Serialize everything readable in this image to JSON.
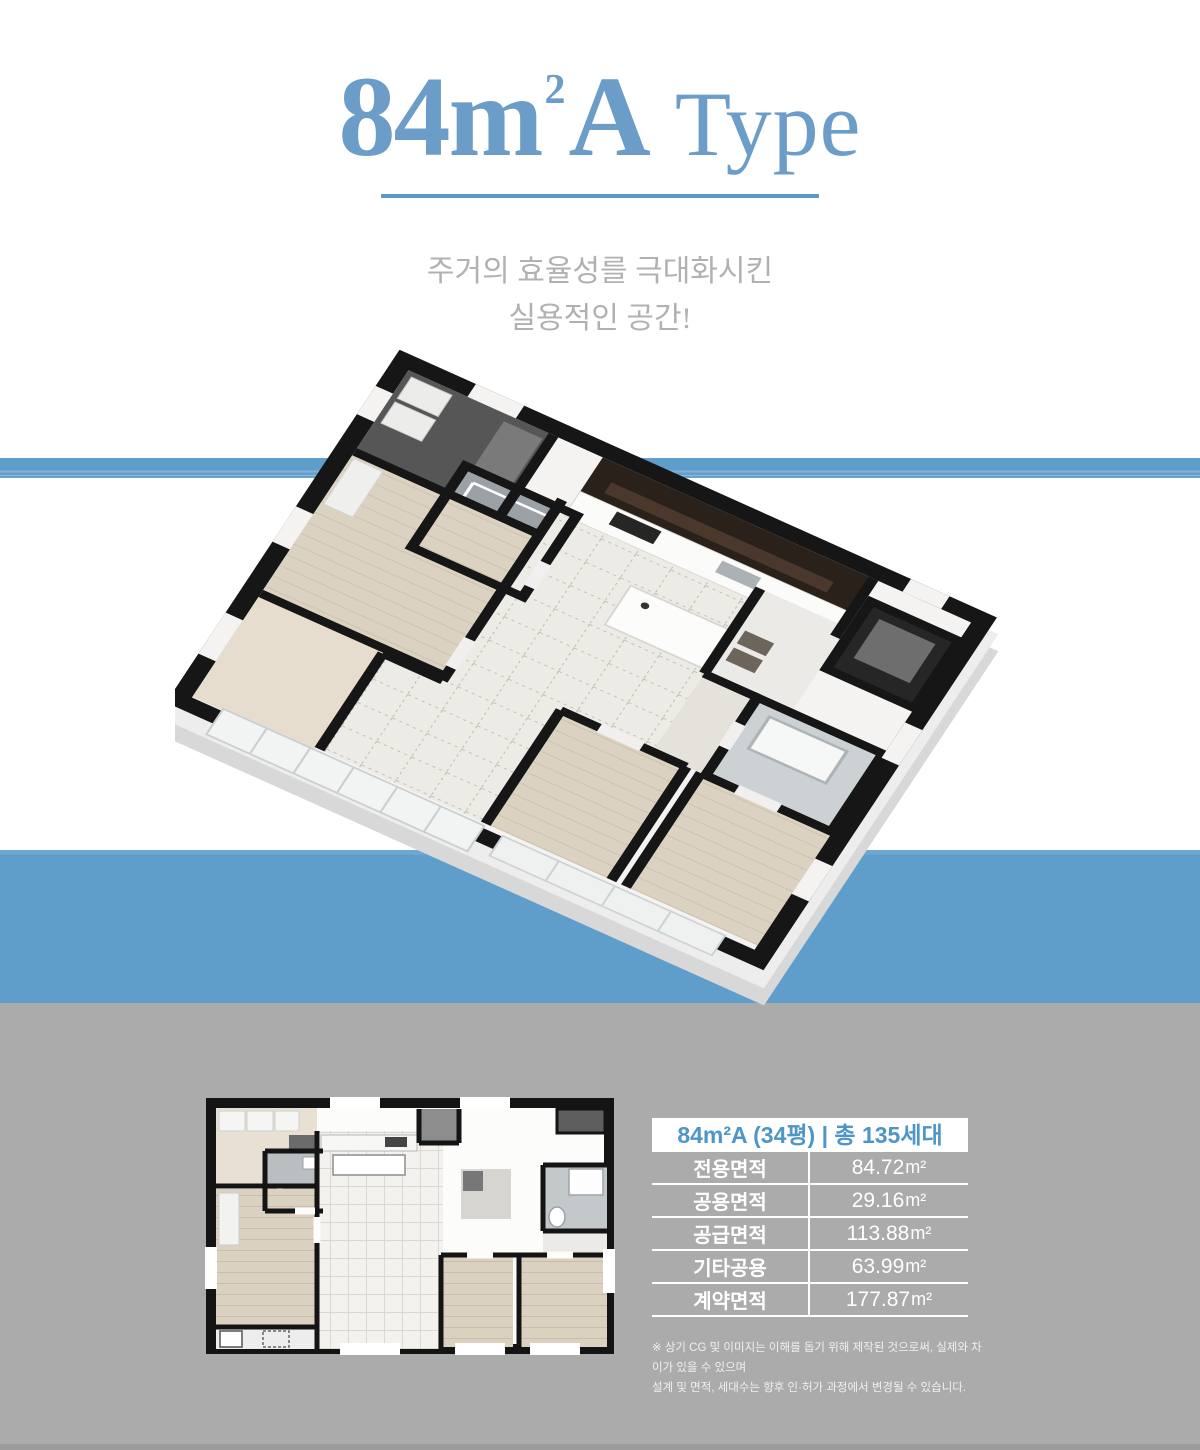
{
  "title": {
    "main": "84m",
    "sup": "2",
    "suffix": "A",
    "type_label": "Type"
  },
  "subtitle": {
    "line1": "주거의 효율성를 극대화시킨",
    "line2": "실용적인 공간!"
  },
  "floorplan": {
    "plan3d_name": "isometric-3d-floorplan-render",
    "plan2d_name": "2d-floorplan-drawing"
  },
  "spec_table": {
    "header": "84m²A (34평) | 총 135세대",
    "rows": [
      {
        "label": "전용면적",
        "value": "84.72",
        "unit": "m²"
      },
      {
        "label": "공용면적",
        "value": "29.16",
        "unit": "m²"
      },
      {
        "label": "공급면적",
        "value": "113.88",
        "unit": "m²"
      },
      {
        "label": "기타공용",
        "value": "63.99",
        "unit": "m²"
      },
      {
        "label": "계약면적",
        "value": "177.87",
        "unit": "m²"
      }
    ]
  },
  "disclaimer": {
    "line1": "※ 상기 CG 및 이미지는 이해를 돕기 위해 제작된 것으로써, 실제와 차이가 있을 수 있으며",
    "line2": "설계 및 면적, 세대수는 향후 인·허가 과정에서 변경될 수 있습니다."
  },
  "colors": {
    "accent_blue": "#5f9ecb",
    "title_blue": "#6b9dc8",
    "table_header_blue": "#4e95c8",
    "section_gray": "#ababab",
    "subtitle_gray": "#b2b0b0"
  }
}
